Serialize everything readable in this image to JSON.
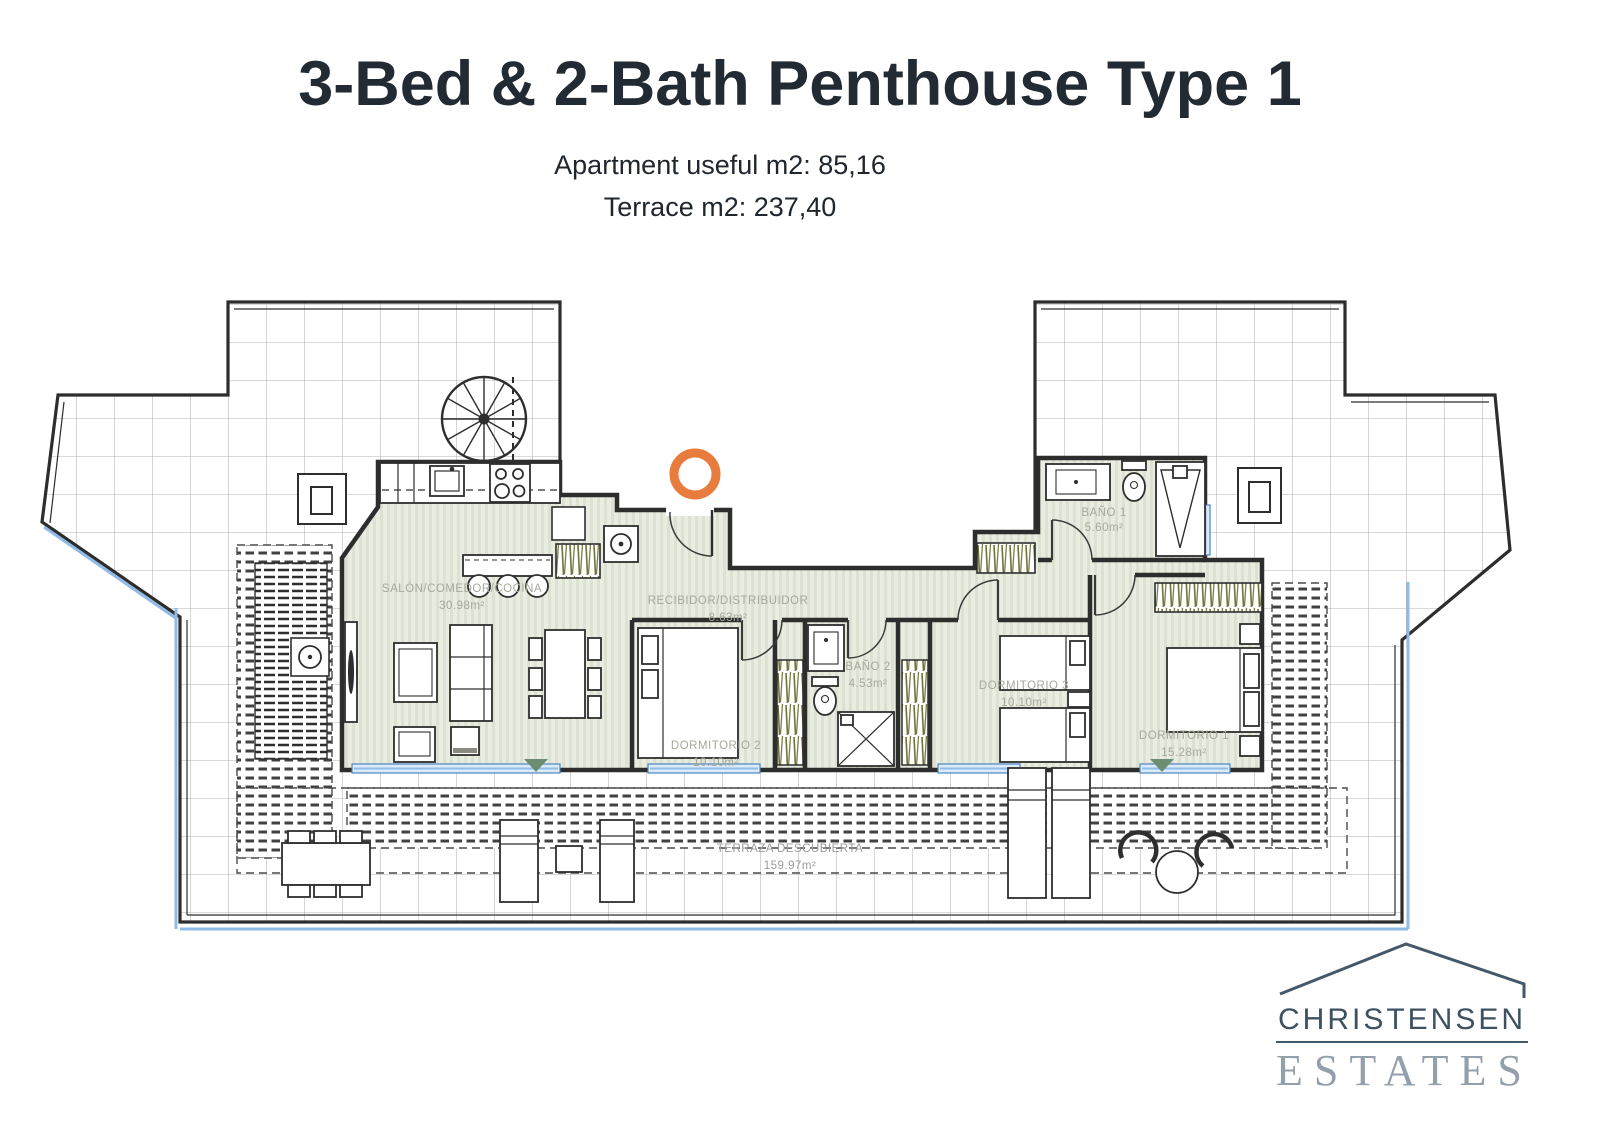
{
  "header": {
    "title": "3-Bed & 2-Bath Penthouse Type 1",
    "line1": "Apartment useful m2: 85,16",
    "line2": "Terrace m2: 237,40"
  },
  "plan": {
    "rooms": [
      {
        "name": "SALÓN/COMEDOR/COCINA",
        "area": "30.98m²"
      },
      {
        "name": "RECIBIDOR/DISTRIBUIDOR",
        "area": "8.63m²"
      },
      {
        "name": "BAÑO 1",
        "area": "5.60m²"
      },
      {
        "name": "BAÑO 2",
        "area": "4.53m²"
      },
      {
        "name": "DORMITORIO 2",
        "area": "10.10m²"
      },
      {
        "name": "DORMITORIO 3",
        "area": "10.10m²"
      },
      {
        "name": "DORMITORIO 1",
        "area": "15.28m²"
      },
      {
        "name": "TERRAZA DESCUBIERTA",
        "area": "159.97m²"
      }
    ],
    "colors": {
      "accent_orange": "#E87B3E",
      "glass_blue": "#8FBBE6",
      "plant_green": "#6E713C",
      "wall": "#2D2D2D",
      "label": "#A5A99A"
    }
  },
  "logo": {
    "line1": "CHRISTENSEN",
    "line2": "ESTATES"
  }
}
